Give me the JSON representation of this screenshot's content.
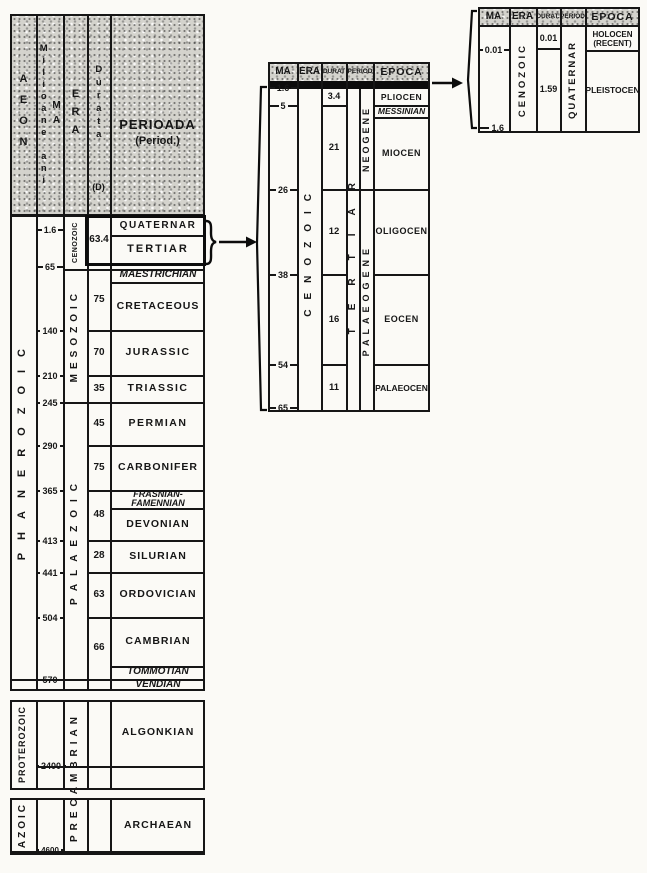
{
  "main_table": {
    "header": {
      "aeon": "AEON",
      "milioane_ani": "Milioane ani",
      "ma": "MA",
      "era": "ERA",
      "durata": "Durata",
      "durata_d": "(D)",
      "perioada": "PERIOADA",
      "perioada_sub": "(Period.)"
    },
    "aeons": [
      "PHANEROZOIC",
      "PROTEROZOIC",
      "AZOIC"
    ],
    "eras": [
      "CENOZOIC",
      "MESOZOIC",
      "PALAEZOIC",
      "PRECAMBRIAN"
    ],
    "ticks": [
      "1.6",
      "65",
      "140",
      "210",
      "245",
      "290",
      "365",
      "413",
      "441",
      "504",
      "570",
      "2400",
      "4600"
    ],
    "durations": [
      "63.4",
      "75",
      "70",
      "35",
      "45",
      "75",
      "48",
      "28",
      "63",
      "66"
    ],
    "periods": [
      "QUATERNAR",
      "TERTIAR",
      "MAESTRICHIAN",
      "CRETACEOUS",
      "JURASSIC",
      "TRIASSIC",
      "PERMIAN",
      "CARBONIFER",
      "FRASNIAN-FAMENNIAN",
      "DEVONIAN",
      "SILURIAN",
      "ORDOVICIAN",
      "CAMBRIAN",
      "TOMMOTIAN",
      "VENDIAN",
      "ALGONKIAN",
      "ARCHAEAN"
    ]
  },
  "cenozoic_table": {
    "header": {
      "ma": "MA",
      "era": "ERA",
      "durat": "DURAT",
      "period": "PERIOD",
      "epoca": "EPOCA"
    },
    "era": "CENOZOIC",
    "period": "TERTIAR",
    "subperiods": [
      "NEOGENE",
      "PALAEOGENE"
    ],
    "ticks": [
      "1.6",
      "5",
      "26",
      "38",
      "54",
      "65"
    ],
    "durations": [
      "3.4",
      "21",
      "12",
      "16",
      "11"
    ],
    "epochs": [
      "PLIOCEN",
      "MESSINIAN",
      "MIOCEN",
      "OLIGOCEN",
      "EOCEN",
      "PALAEOCEN"
    ]
  },
  "quaternary_table": {
    "header": {
      "ma": "MA",
      "era": "ERA",
      "durat": "DURAT.",
      "period": "PERIOD",
      "epoca": "EPOCA"
    },
    "era": "CENOZOIC",
    "period": "QUATERNAR",
    "ticks": [
      "0.01",
      "1.6"
    ],
    "durations": [
      "0.01",
      "1.59"
    ],
    "epochs": [
      "HOLOCEN",
      "(RECENT)",
      "PLEISTOCEN"
    ]
  }
}
